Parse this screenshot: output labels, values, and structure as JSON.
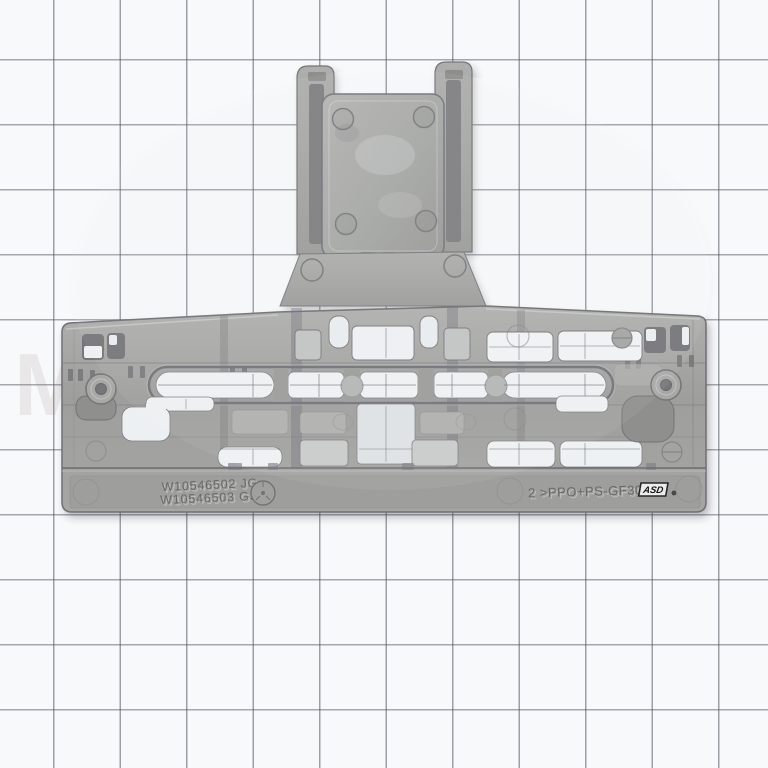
{
  "photo": {
    "paper_color": "#f8f9fb",
    "grid_line_color": "#50565e",
    "part_color": "#a2a2a0"
  },
  "markings": {
    "part_numbers": [
      "W10546502 JG",
      "W10546503 GS"
    ],
    "material_code": "2 >PPO+PS-GF30<",
    "logo_badge": "ASD"
  },
  "watermark": {
    "text": "MarconeParts"
  }
}
